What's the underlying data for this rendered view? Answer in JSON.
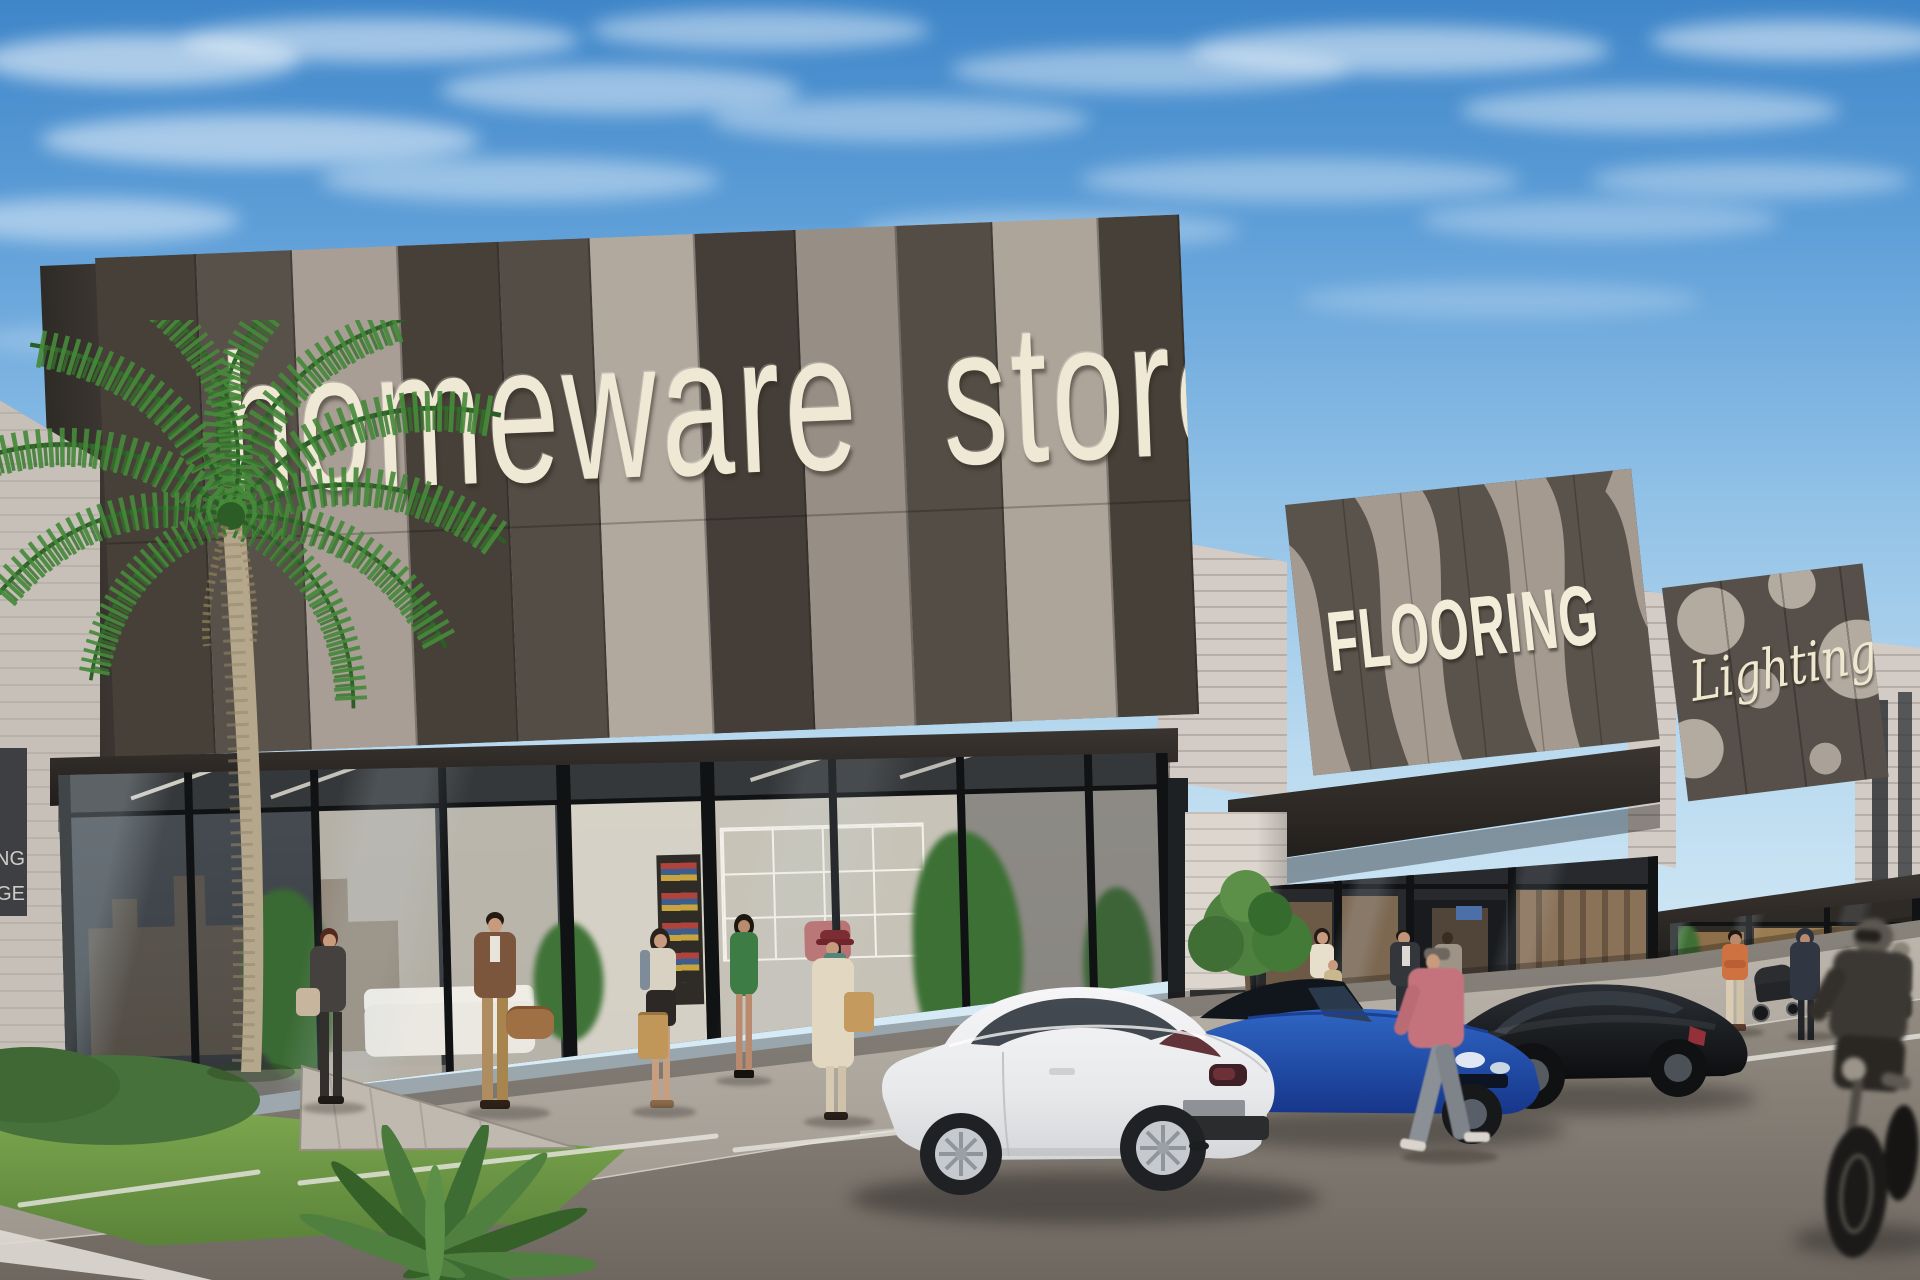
{
  "image": {
    "width": 1920,
    "height": 1280,
    "type": "photorealistic architectural rendering",
    "description": "Sunny strip-mall retail facade with three storefronts (homeware store, FLOORING, Lighting), palm tree, pedestrians, parked cars and a passing motorcyclist"
  },
  "signs": {
    "homeware": {
      "text": "homeware store"
    },
    "flooring": {
      "text": "FLOORING"
    },
    "lighting": {
      "text": "Lighting"
    },
    "side_sign": {
      "line1": "NG",
      "line2": "GE"
    }
  },
  "palette": {
    "sky_top": "#4a92cf",
    "sky_horizon": "#d9edf7",
    "cloud": "#ffffff",
    "facade_panel_dark": "#4a443e",
    "facade_panel_taupe": "#a0978e",
    "facade_panel_light": "#b1a89e",
    "sign_letters": "#efe8d5",
    "canopy": "#2f2a26",
    "brick_light": "#d3cbc5",
    "brick_white": "#e0dad4",
    "glass_reflection": "#3d464e",
    "interior_warm": "#ddd6c8",
    "sidewalk": "#b4aea5",
    "asphalt": "#7e7870",
    "grass": "#6f9c45",
    "palm_green": "#47833a",
    "palm_trunk": "#b3a488",
    "car_white": "#eceff1",
    "car_blue": "#2b5cb8",
    "car_black": "#1a1c1f",
    "parking_line": "#e9e7e1"
  },
  "vehicles": [
    {
      "name": "white-coupe",
      "color": "#eceff1",
      "position": "center foreground, rear three-quarter view"
    },
    {
      "name": "blue-sedan",
      "color": "#2b5cb8",
      "position": "right of white coupe"
    },
    {
      "name": "black-sedan",
      "color": "#1a1c1f",
      "position": "in front of FLOORING store"
    },
    {
      "name": "motorcycle",
      "color": "#2d2a26",
      "position": "far right, rider passing, motion-blurred"
    },
    {
      "name": "stroller",
      "color": "#27292d",
      "position": "near Lighting store"
    }
  ],
  "people": [
    {
      "name": "woman-with-handbag",
      "outfit": "#45413e"
    },
    {
      "name": "man-brown-suit",
      "outfit": "#7b563d",
      "accessory": "tan duffel bag"
    },
    {
      "name": "woman-shopper",
      "outfit": "#d9d2c2",
      "accessory": "kraft shopping bag"
    },
    {
      "name": "woman-green-dress",
      "outfit": "#3e7c46"
    },
    {
      "name": "woman-red-hat",
      "outfit": "#e2d7c1",
      "accessory": "maroon hat, teal scarf, tan bag"
    },
    {
      "name": "woman-cream-top",
      "outfit": "#e7dfcb"
    },
    {
      "name": "child",
      "outfit": "#c9b88e"
    },
    {
      "name": "man-dark-jacket",
      "outfit": "#33373b"
    },
    {
      "name": "person-grey-coat",
      "outfit": "#9d9487"
    },
    {
      "name": "walker-pink-top",
      "outfit": "#c4737c"
    },
    {
      "name": "man-orange-shirt",
      "outfit": "#cf7242"
    },
    {
      "name": "woman-with-stroller",
      "outfit": "#303642"
    },
    {
      "name": "motorcyclist",
      "outfit": "#3b3834"
    },
    {
      "name": "scooter-rider",
      "outfit": "#4a463f"
    }
  ],
  "landscape": {
    "palm_tree": true,
    "small_tree": true,
    "grass_planter": true,
    "ivy": true,
    "concrete_wedge": true
  }
}
